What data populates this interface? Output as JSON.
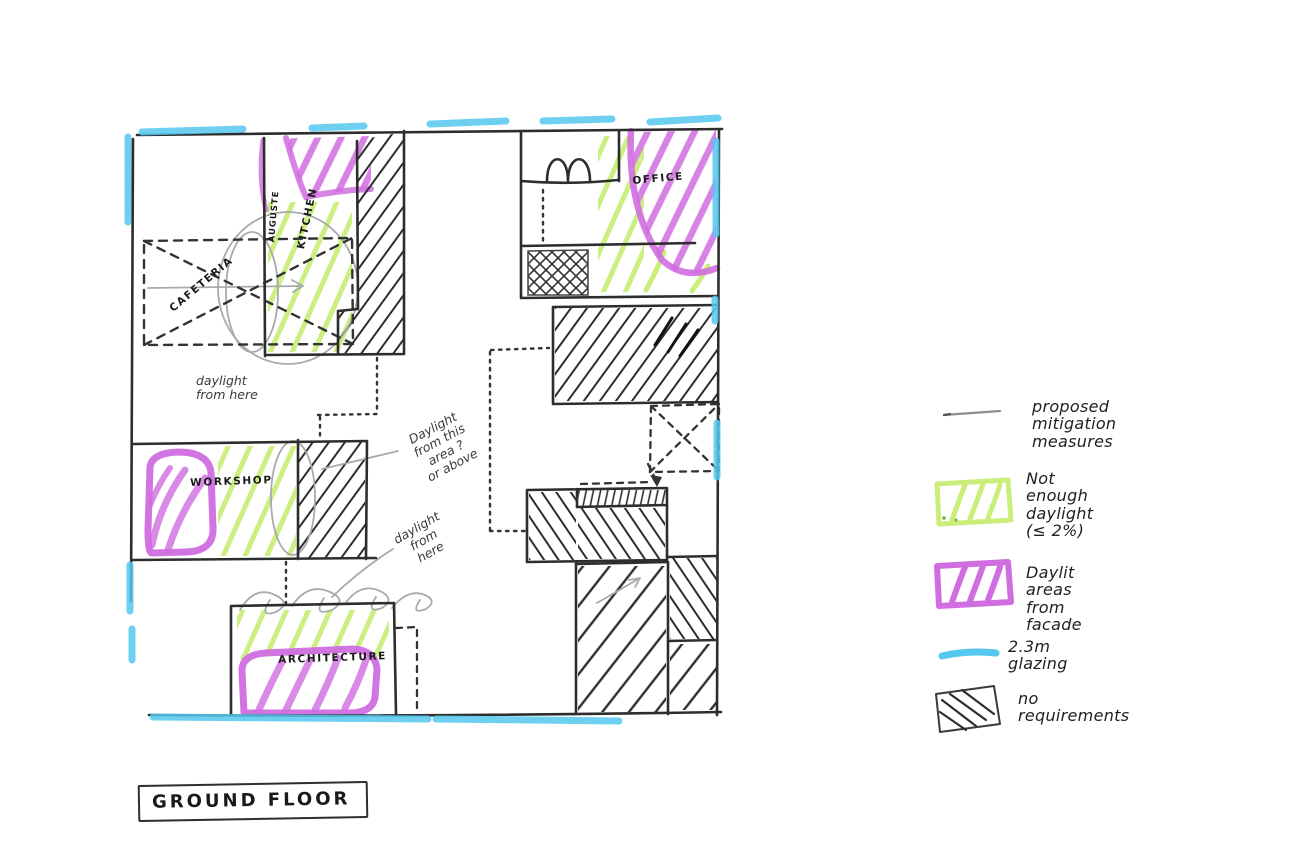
{
  "title_box": {
    "label": "GROUND FLOOR"
  },
  "plan": {
    "room_labels": {
      "kitchen": "KITCHEN",
      "kitchen_side": "AUGUSTE",
      "cafeteria": "CAFETERIA",
      "workshop": "WORKSHOP",
      "architecture": "ARCHITECTURE",
      "office": "OFFICE"
    },
    "annotations": {
      "daylight_left": "daylight\nfrom here",
      "daylight_mid": "Daylight\nfrom this\narea ?\nor above",
      "daylight_lower": "daylight\nfrom\nhere"
    }
  },
  "legend": {
    "items": [
      {
        "id": "proposed-mitigation",
        "swatch": "gray-line",
        "label": "proposed\nmitigation\nmeasures"
      },
      {
        "id": "not-enough-daylight",
        "swatch": "green-hatch-box",
        "label": "Not enough\ndaylight\n(≤ 2%)"
      },
      {
        "id": "daylit-areas",
        "swatch": "purple-hatch-box",
        "label": "Daylit areas\nfrom facade"
      },
      {
        "id": "glazing",
        "swatch": "cyan-line",
        "label": "2.3m glazing"
      },
      {
        "id": "no-requirements",
        "swatch": "black-hatch-box",
        "label": "no\nrequirements"
      }
    ]
  },
  "colors": {
    "sketch_black": "#2d2d2d",
    "pencil_gray": "#a8a8a8",
    "highlight_green": "#c9ee7a",
    "highlight_purple": "#d06de0",
    "highlight_cyan": "#55c8ef"
  }
}
